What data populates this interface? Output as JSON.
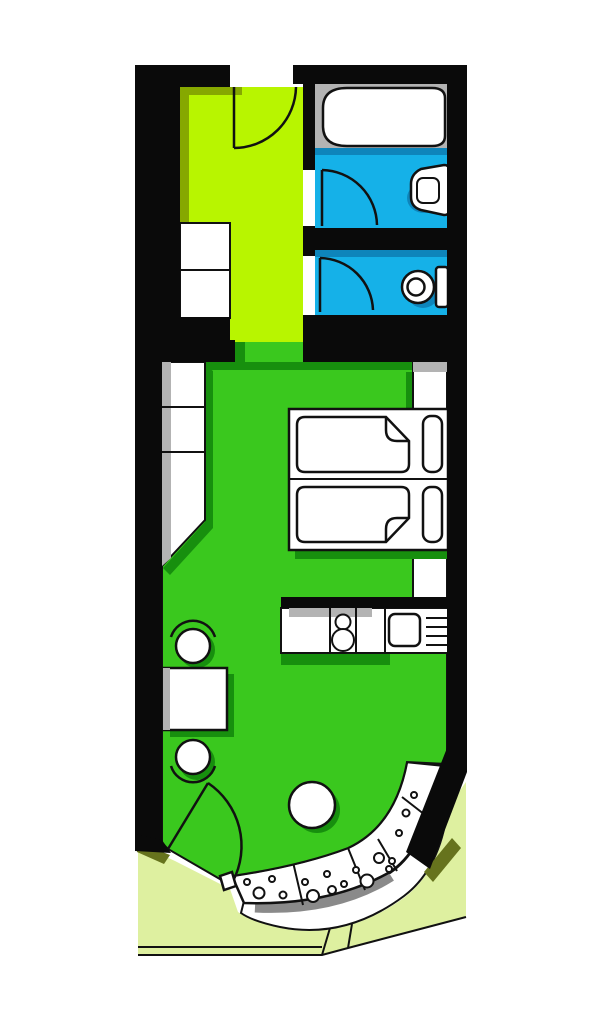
{
  "title": "studio-apartment-floor-plan",
  "colors": {
    "page_bg": "#ffffff",
    "wall": "#0a0a0a",
    "outline": "#111111",
    "hall_floor": "#b8f500",
    "hall_shadow": "#86a800",
    "main_floor": "#3ac81e",
    "main_shadow": "#178f0e",
    "wet_floor": "#15b1e8",
    "wet_shadow": "#0e85bb",
    "platform_grey": "#b3b3b3",
    "shadow_grey": "#8a8a8a",
    "lawn": "#def0a0",
    "lawn_shadow": "#66731d",
    "fixture_white": "#ffffff"
  },
  "regions": [
    {
      "id": "entry-hall",
      "floor_color": "hall_floor"
    },
    {
      "id": "bathroom",
      "floor_color": "wet_floor"
    },
    {
      "id": "wc",
      "floor_color": "wet_floor"
    },
    {
      "id": "main-room",
      "floor_color": "main_floor"
    },
    {
      "id": "balcony-bay",
      "floor_color": "fixture_white"
    },
    {
      "id": "lawn",
      "floor_color": "lawn"
    }
  ],
  "fixtures": [
    "entry-door",
    "hall-wardrobe",
    "bathtub",
    "washbasin",
    "bathroom-door",
    "toilet",
    "wc-door",
    "closet-column",
    "bed-upper",
    "bed-lower",
    "kitchen-counter",
    "stove-burners",
    "kitchen-sink",
    "dining-table",
    "chair-upper",
    "chair-lower",
    "round-table",
    "balcony-door",
    "balcony-pebble-band",
    "balcony-rim",
    "garden-path"
  ],
  "balcony": {
    "pebbles": [
      [
        247,
        882,
        3
      ],
      [
        259,
        893,
        5.5
      ],
      [
        272,
        879,
        3
      ],
      [
        283,
        895,
        3.5
      ],
      [
        305,
        882,
        3
      ],
      [
        313,
        896,
        6
      ],
      [
        327,
        874,
        3
      ],
      [
        332,
        890,
        4
      ],
      [
        344,
        884,
        3
      ],
      [
        356,
        870,
        3
      ],
      [
        367,
        881,
        6.5
      ],
      [
        379,
        858,
        5
      ],
      [
        389,
        869,
        3
      ],
      [
        392,
        861,
        3
      ],
      [
        399,
        833,
        3
      ],
      [
        406,
        813,
        3.5
      ],
      [
        414,
        795,
        3
      ]
    ]
  }
}
